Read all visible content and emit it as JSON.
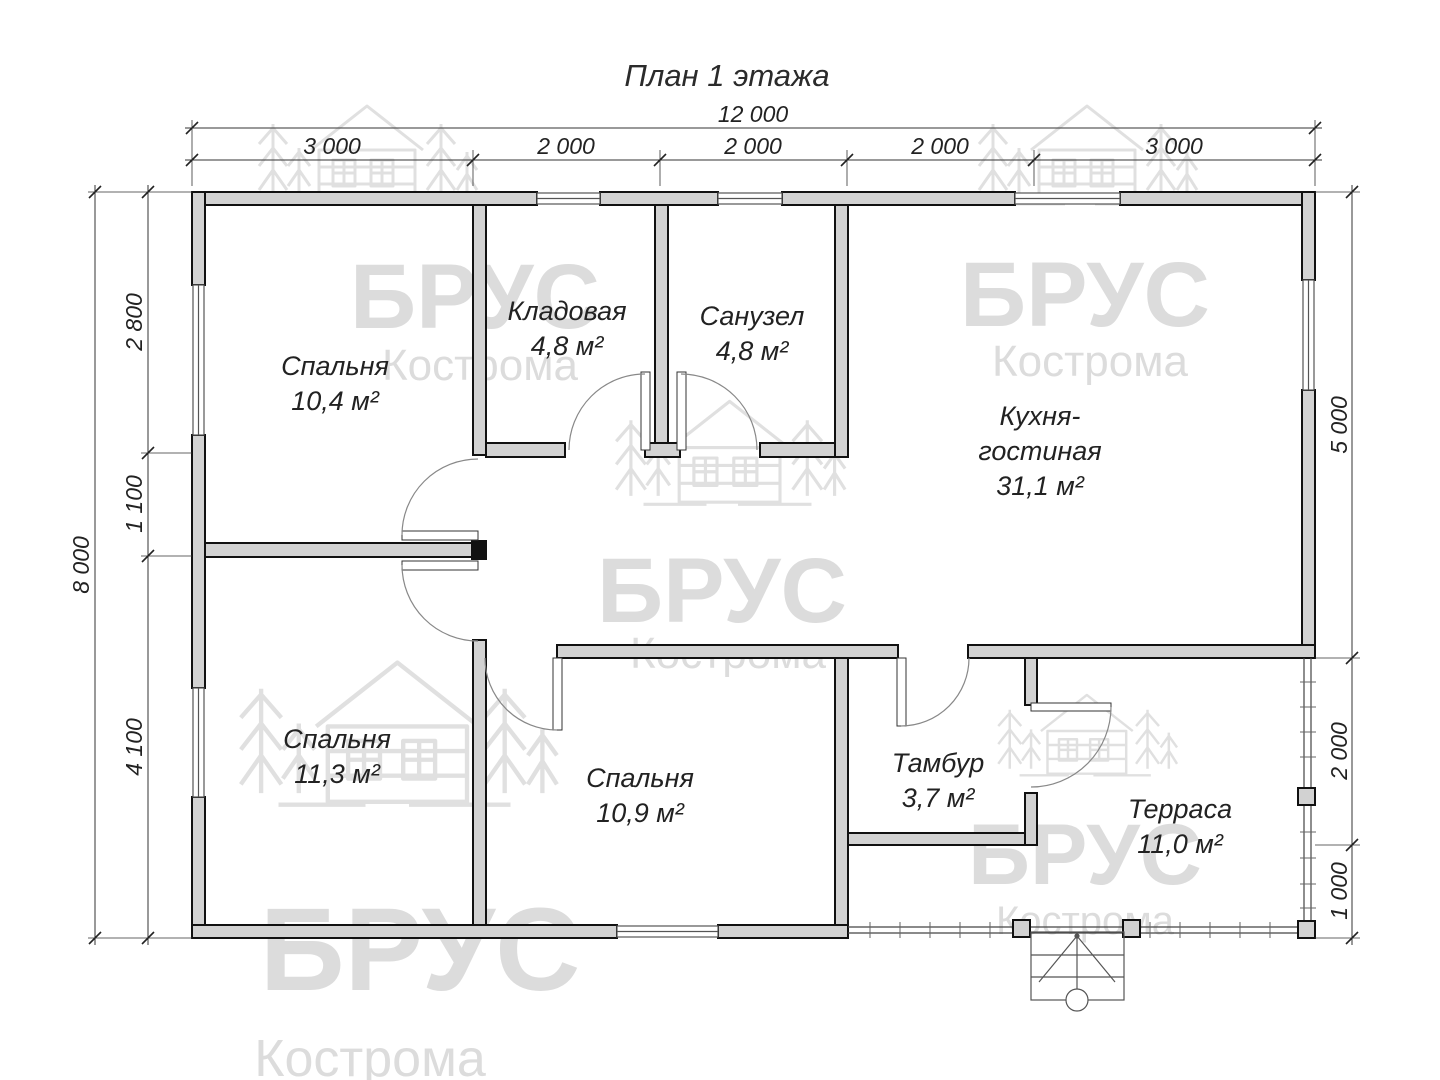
{
  "title": "План 1 этажа",
  "watermark": {
    "brand": "БРУС",
    "city": "Кострома"
  },
  "dimensions": {
    "top": {
      "total": "12 000",
      "segments": [
        "3 000",
        "2 000",
        "2 000",
        "2 000",
        "3 000"
      ]
    },
    "left": {
      "total": "8 000",
      "segments": [
        "2 800",
        "1 100",
        "4 100"
      ]
    },
    "right": {
      "segments": [
        "5 000",
        "2 000",
        "1 000"
      ]
    }
  },
  "rooms": {
    "bedroom1": {
      "name": "Спальня",
      "area": "10,4 м²"
    },
    "storage": {
      "name": "Кладовая",
      "area": "4,8 м²"
    },
    "bathroom": {
      "name": "Санузел",
      "area": "4,8 м²"
    },
    "kitchen": {
      "name_line1": "Кухня-",
      "name_line2": "гостиная",
      "area": "31,1 м²"
    },
    "bedroom2": {
      "name": "Спальня",
      "area": "11,3 м²"
    },
    "bedroom3": {
      "name": "Спальня",
      "area": "10,9 м²"
    },
    "vestibule": {
      "name": "Тамбур",
      "area": "3,7 м²"
    },
    "terrace": {
      "name": "Терраса",
      "area": "11,0 м²"
    }
  }
}
